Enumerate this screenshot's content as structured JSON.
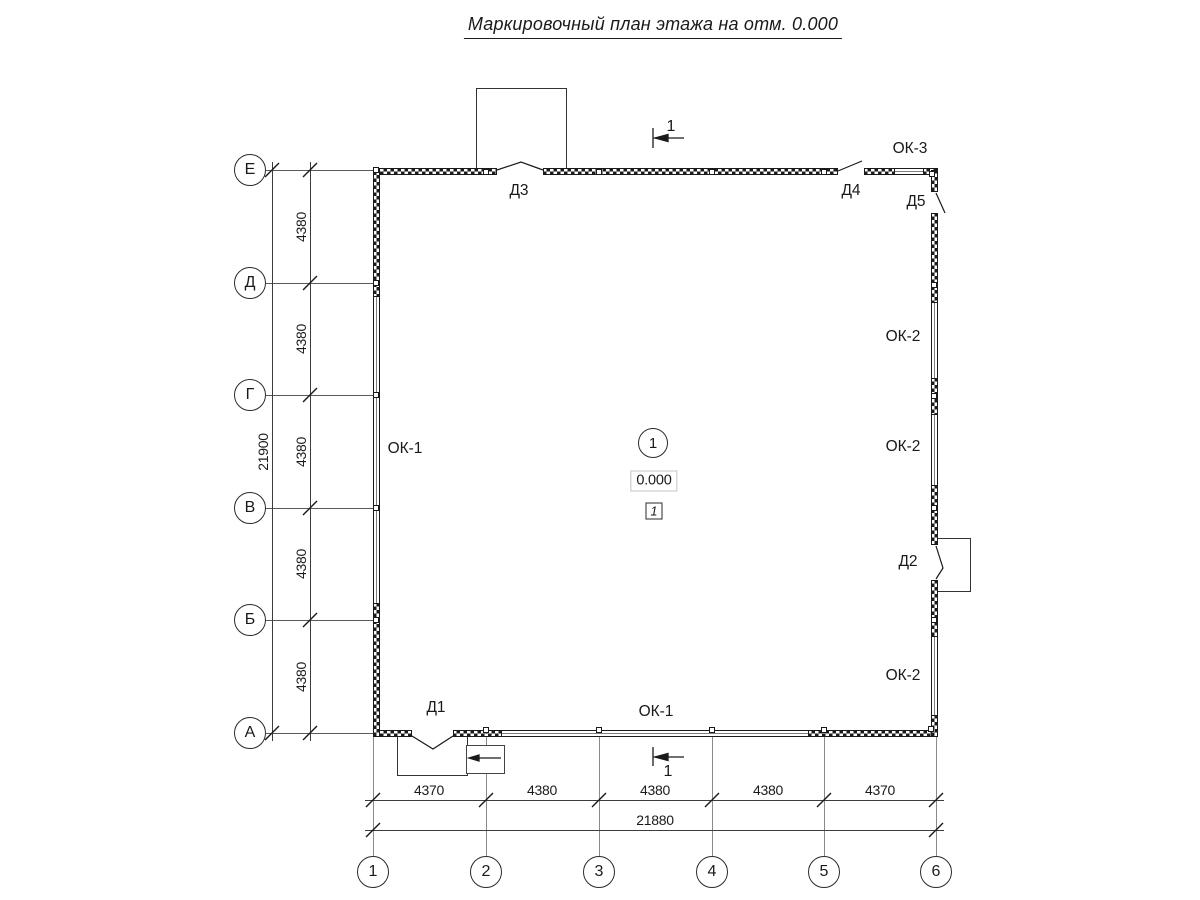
{
  "title": "Маркировочный план этажа на отм. 0.000",
  "axes": {
    "rows": [
      "Е",
      "Д",
      "Г",
      "В",
      "Б",
      "А"
    ],
    "cols": [
      "1",
      "2",
      "3",
      "4",
      "5",
      "6"
    ]
  },
  "dims": {
    "left_segments": [
      "4380",
      "4380",
      "4380",
      "4380",
      "4380"
    ],
    "left_total": "21900",
    "bottom_segments": [
      "4370",
      "4380",
      "4380",
      "4380",
      "4370"
    ],
    "bottom_total": "21880"
  },
  "windows": {
    "ok1": "ОК-1",
    "ok2": "ОК-2",
    "ok3": "ОК-3"
  },
  "doors": {
    "d1": "Д1",
    "d2": "Д2",
    "d3": "Д3",
    "d4": "Д4",
    "d5": "Д5"
  },
  "room": {
    "number": "1",
    "elevation": "0.000",
    "zone": "1"
  },
  "section": {
    "label": "1"
  },
  "colors": {
    "ink": "#1a1a1a"
  }
}
